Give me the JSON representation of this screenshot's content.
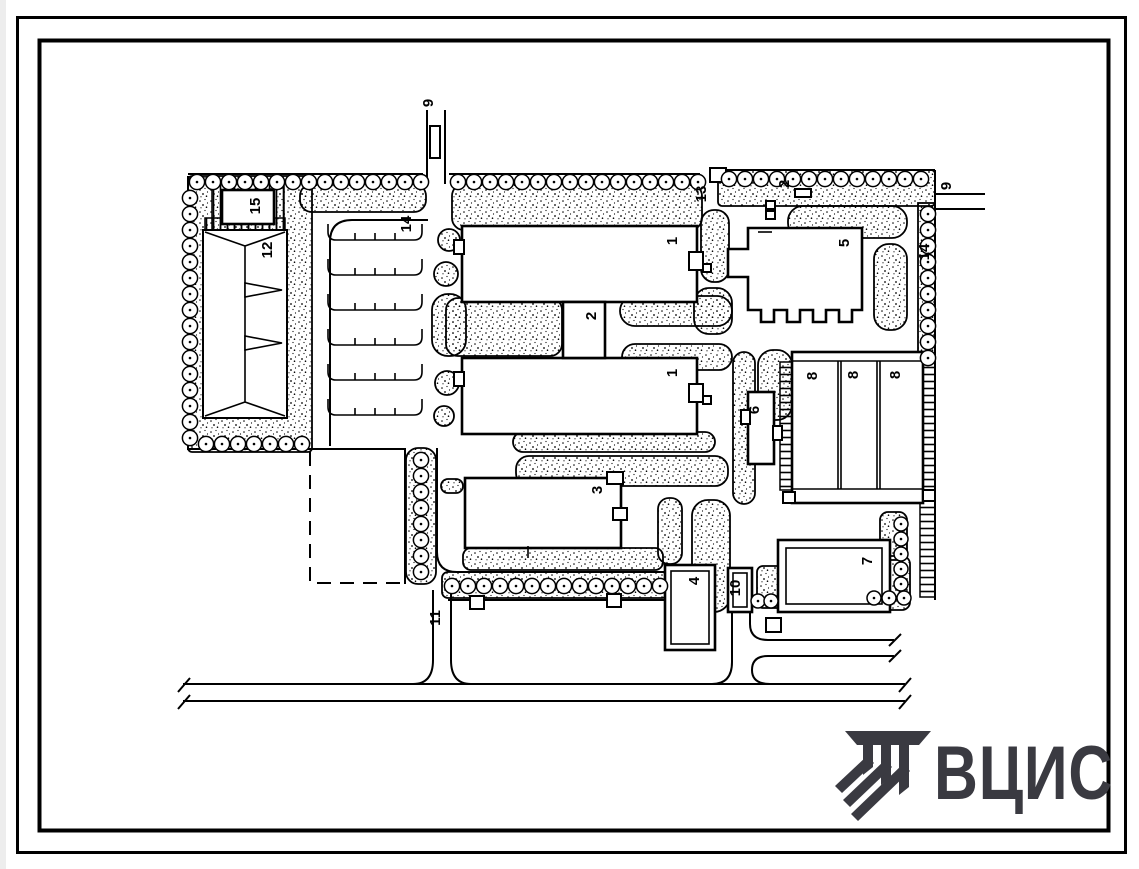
{
  "sheet": {
    "paper_color": "#ffffff",
    "ink_color": "#000000"
  },
  "plan": {
    "labels": [
      {
        "id": "road-9-top",
        "text": "9"
      },
      {
        "id": "structure-15",
        "text": "15"
      },
      {
        "id": "area-12",
        "text": "12"
      },
      {
        "id": "parking-14",
        "text": "14"
      },
      {
        "id": "building-1-upper",
        "text": "1"
      },
      {
        "id": "link-2",
        "text": "2"
      },
      {
        "id": "structure-13",
        "text": "13"
      },
      {
        "id": "structure-2-small",
        "text": "2"
      },
      {
        "id": "building-5",
        "text": "5"
      },
      {
        "id": "road-9-right",
        "text": "9"
      },
      {
        "id": "strip-14-right",
        "text": "14"
      },
      {
        "id": "building-1-lower",
        "text": "1"
      },
      {
        "id": "structure-6",
        "text": "6"
      },
      {
        "id": "garage-8-a",
        "text": "8"
      },
      {
        "id": "garage-8-b",
        "text": "8"
      },
      {
        "id": "garage-8-c",
        "text": "8"
      },
      {
        "id": "building-3",
        "text": "3"
      },
      {
        "id": "building-4",
        "text": "4"
      },
      {
        "id": "structure-10",
        "text": "10"
      },
      {
        "id": "building-7",
        "text": "7"
      },
      {
        "id": "road-11",
        "text": "11"
      }
    ]
  },
  "logo": {
    "text": "ВЦИС",
    "color": "#3a3a41"
  }
}
